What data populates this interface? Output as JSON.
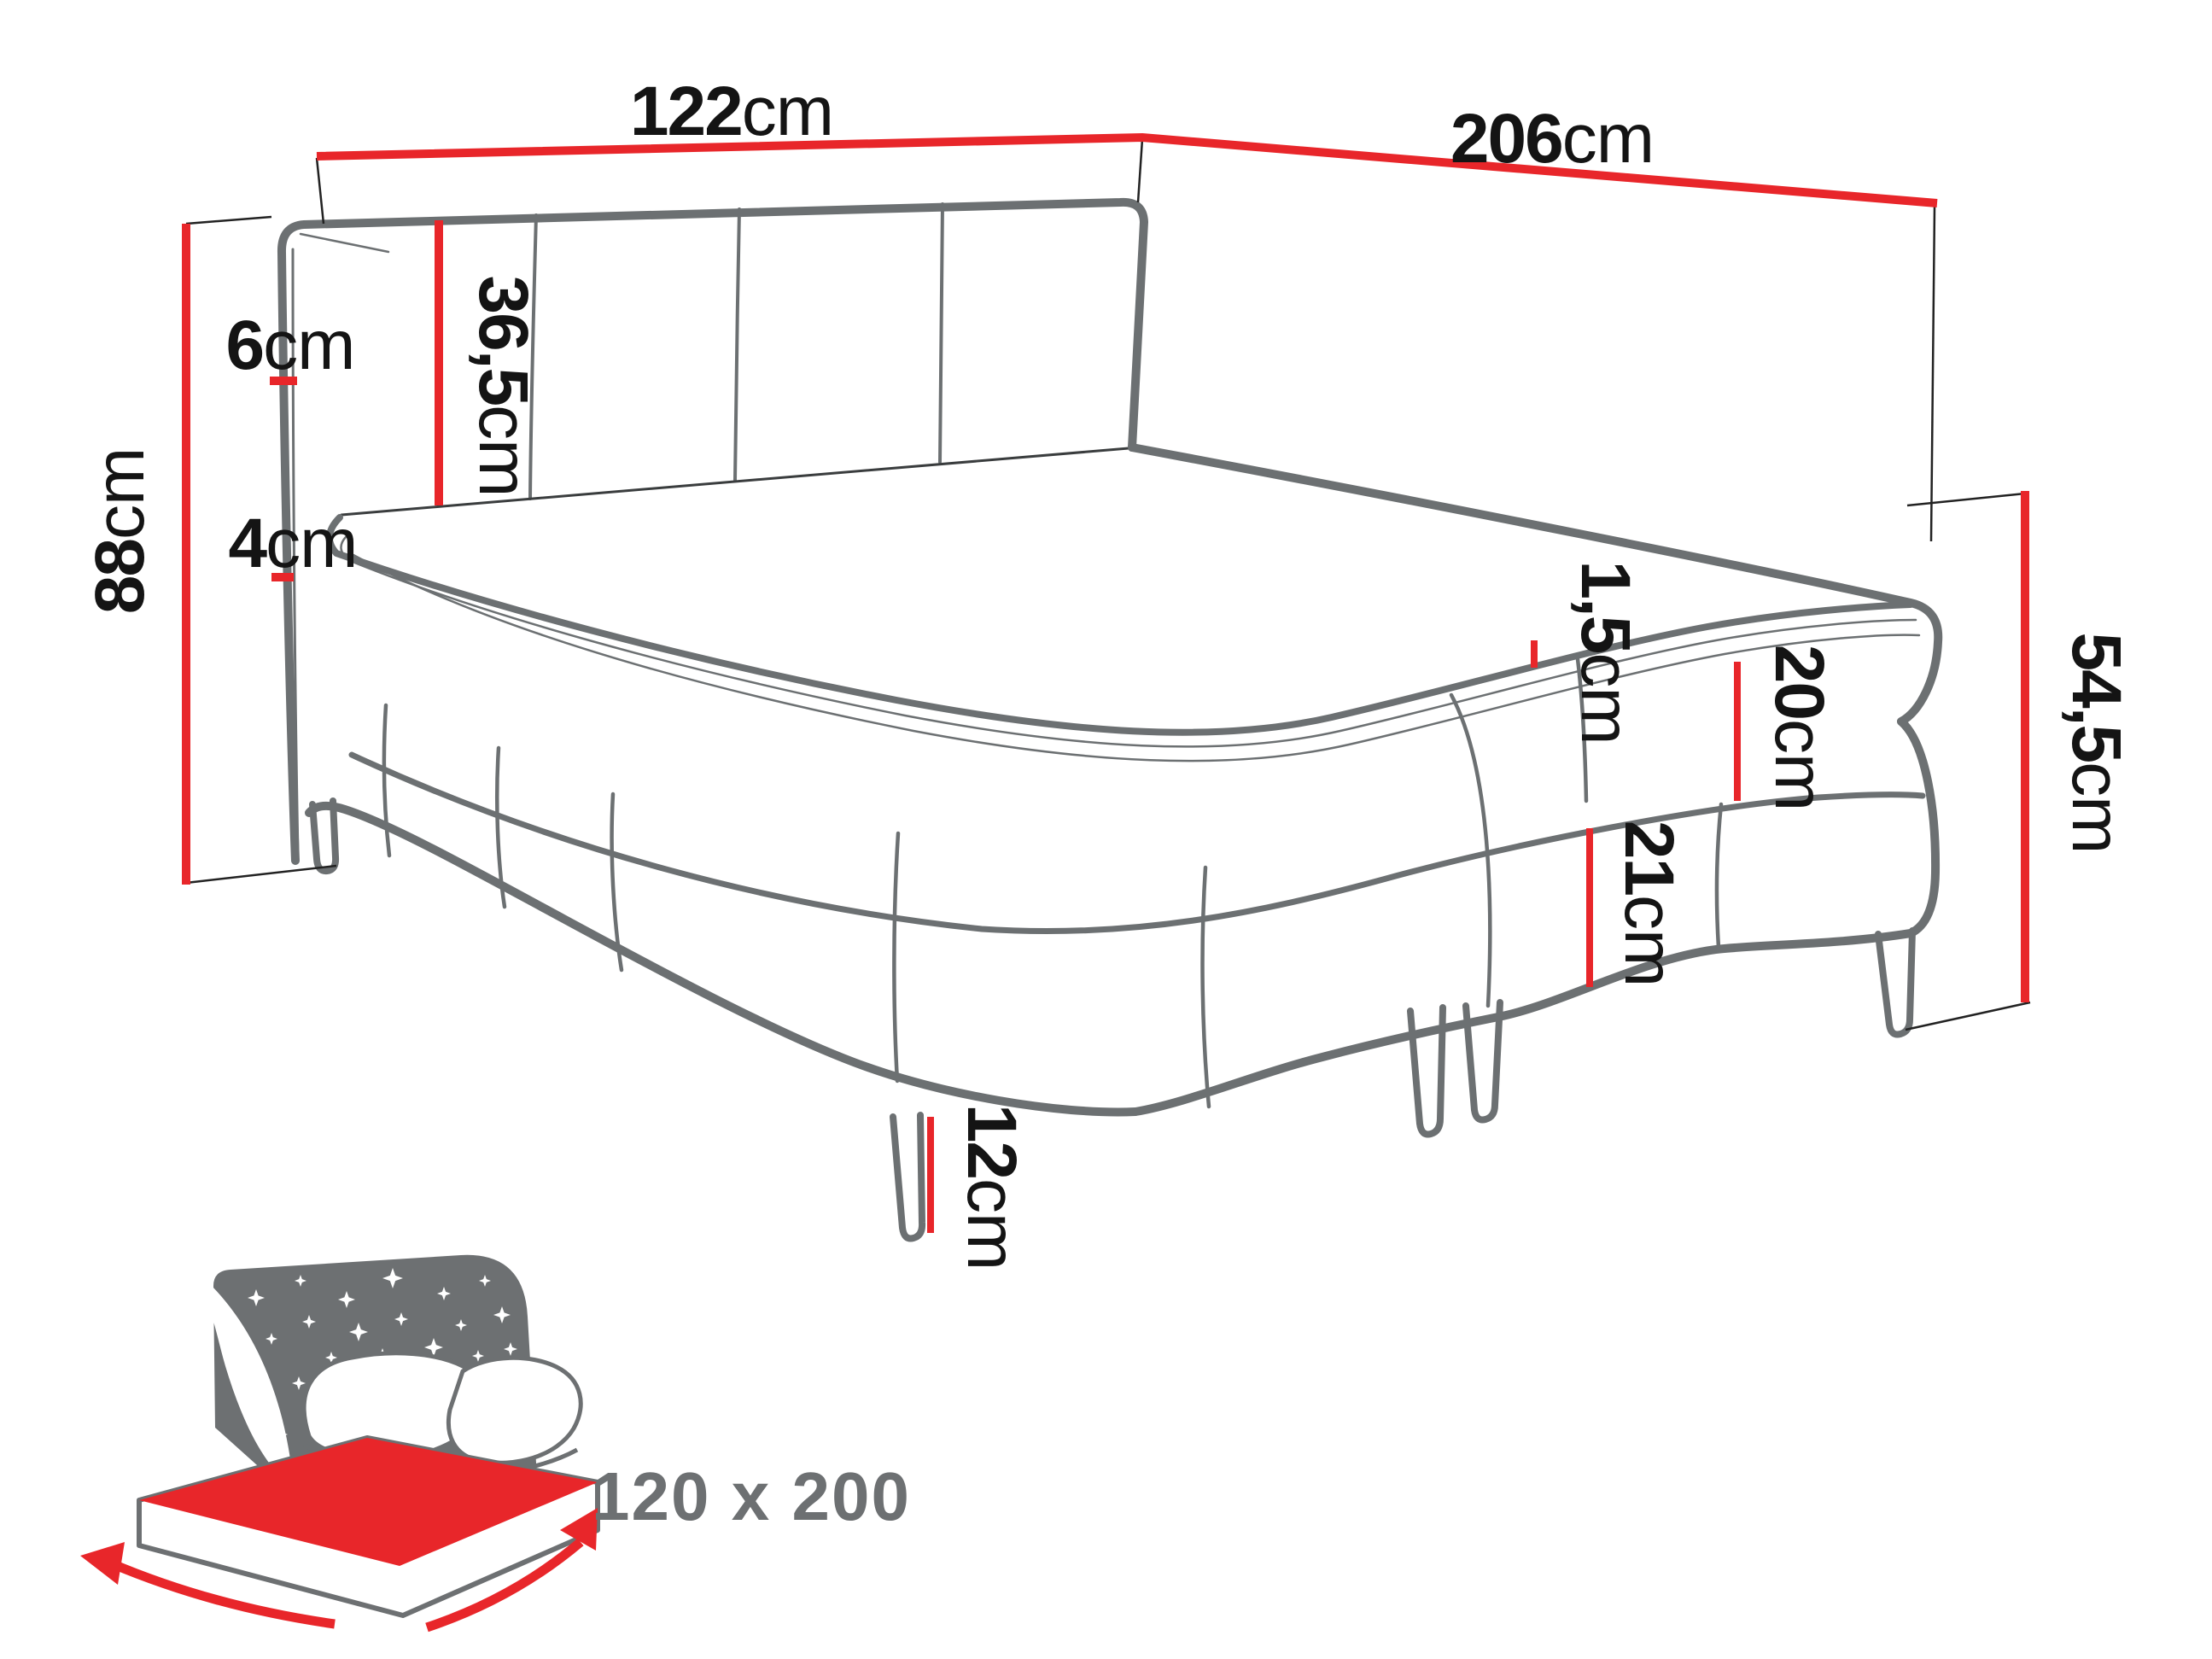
{
  "diagram": {
    "type": "furniture-dimension-diagram",
    "subject": "boxspring bed",
    "colors": {
      "accent_red": "#e8262a",
      "outline_gray": "#6c7072",
      "label_black": "#141414",
      "muted_gray": "#6d7072",
      "background": "#ffffff"
    },
    "dimensions": {
      "headboard_width": {
        "value": "122",
        "unit": "cm",
        "meaning": "width of headboard (top left dimension line)"
      },
      "total_length": {
        "value": "206",
        "unit": "cm",
        "meaning": "length of bed (top right dimension line)"
      },
      "total_height": {
        "value": "88",
        "unit": "cm",
        "meaning": "total height at headboard (left vertical line)"
      },
      "headboard_thickness": {
        "value": "6",
        "unit": "cm",
        "meaning": "headboard panel thickness (small tick)"
      },
      "headboard_panel_height": {
        "value": "36,5",
        "unit": "cm",
        "meaning": "headboard height above mattress (red vertical line)"
      },
      "topper_height": {
        "value": "4",
        "unit": "cm",
        "meaning": "mattress topper thickness (small tick)"
      },
      "piping_height": {
        "value": "1,5",
        "unit": "cm",
        "meaning": "piping / rim band height (small tick)"
      },
      "mattress_height": {
        "value": "20",
        "unit": "cm",
        "meaning": "upper mattress box height (red line)"
      },
      "base_height": {
        "value": "21",
        "unit": "cm",
        "meaning": "lower base box height (red line)"
      },
      "leg_height": {
        "value": "12",
        "unit": "cm",
        "meaning": "leg height (red line)"
      },
      "side_height": {
        "value": "54,5",
        "unit": "cm",
        "meaning": "total height at foot end (right red line)"
      }
    },
    "size_badge": {
      "label": "120 x 200",
      "icon": "bed-with-starry-headboard-and-red-size-arrows"
    }
  }
}
